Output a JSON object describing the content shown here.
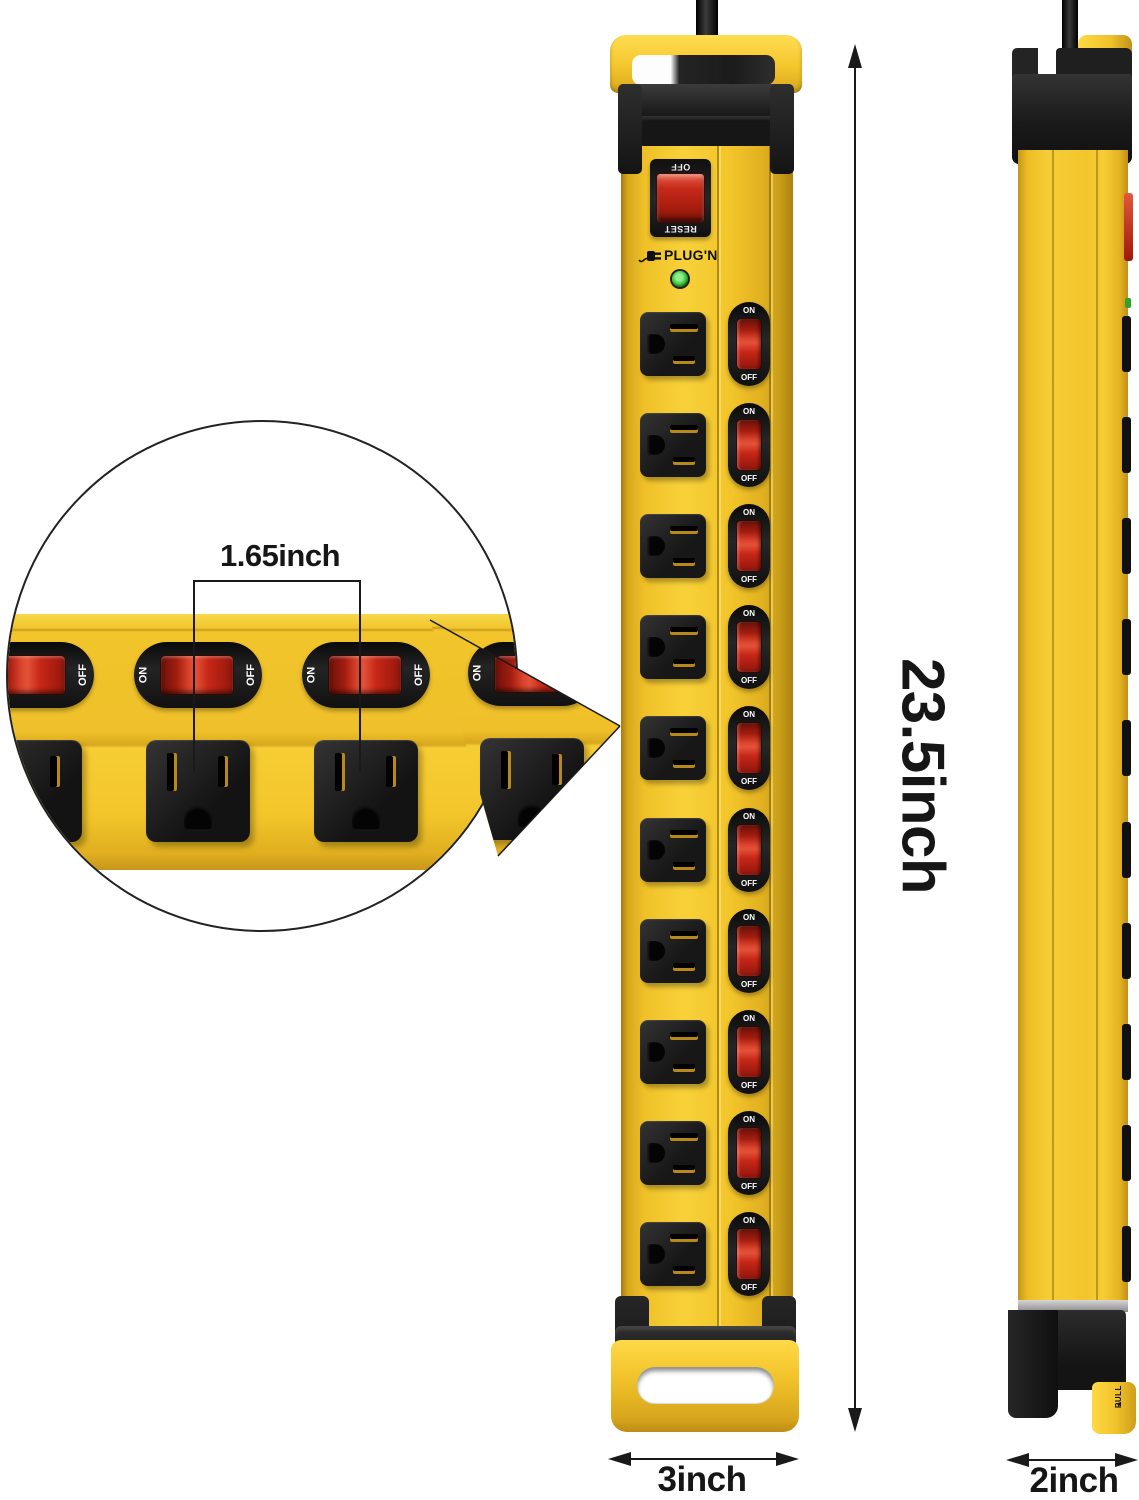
{
  "annotations": {
    "height_label": "23.5inch",
    "width_label": "3inch",
    "depth_label": "2inch",
    "spacing_label": "1.65inch"
  },
  "front_view": {
    "brand": "PLUG'N",
    "breaker_top_label": "OFF",
    "breaker_bottom_label": "RESET",
    "outlet_rows": 10,
    "switch_on_label": "ON",
    "switch_off_label": "OFF"
  },
  "side_view": {
    "pull_tab_label": "PULL",
    "switch_count": 10
  },
  "inset_view": {
    "outlet_count": 4,
    "switch_count": 4,
    "switch_on_label": "ON",
    "switch_off_label": "OFF"
  },
  "colors": {
    "body_yellow": "#F2C42A",
    "body_yellow_dark": "#C79417",
    "switch_red": "#CC2717",
    "housing_black": "#1C1C1C",
    "led_green": "#3BBE3B"
  }
}
